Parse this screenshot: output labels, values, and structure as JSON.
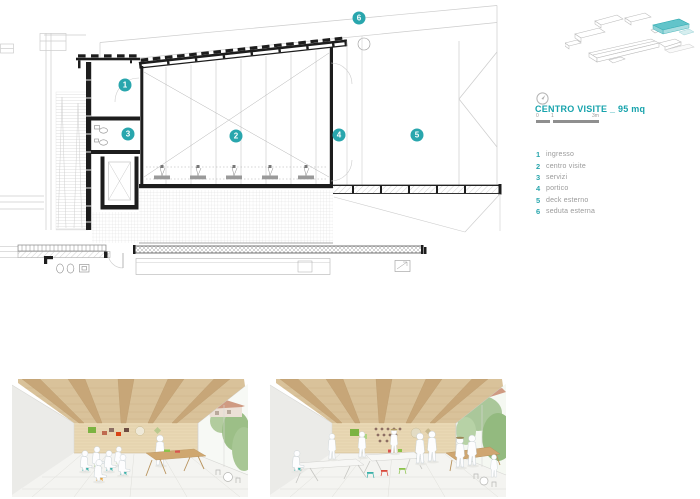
{
  "page": {
    "background": "#ffffff"
  },
  "colors": {
    "accent_teal": "#29a6ad",
    "drawing_dark": "#1d1d1d",
    "drawing_light": "#cccccc",
    "label_gray": "#9a9a9a",
    "wood": "#d9c29a",
    "wood_beam": "#c7a678",
    "foliage_green": "#9cbf87"
  },
  "legend": {
    "title": "CENTRO VISITE _ 95 mq",
    "scale": {
      "t0": "0",
      "t1": "1",
      "t2": "3m"
    },
    "items": [
      {
        "num": "1",
        "label": "ingresso"
      },
      {
        "num": "2",
        "label": "centro visite"
      },
      {
        "num": "3",
        "label": "servizi"
      },
      {
        "num": "4",
        "label": "portico"
      },
      {
        "num": "5",
        "label": "deck esterno"
      },
      {
        "num": "6",
        "label": "seduta esterna"
      }
    ]
  },
  "section": {
    "markers": [
      {
        "num": "1"
      },
      {
        "num": "2"
      },
      {
        "num": "3"
      },
      {
        "num": "4"
      },
      {
        "num": "5"
      },
      {
        "num": "6"
      }
    ]
  }
}
